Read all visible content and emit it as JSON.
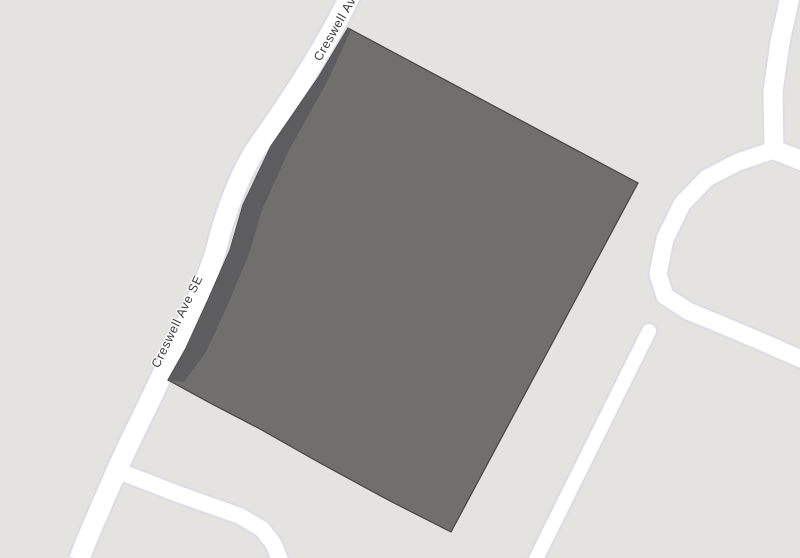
{
  "map": {
    "type": "street-map-view",
    "street_labels": [
      {
        "id": "creswell-label-top",
        "text": "Creswell Ave SE",
        "visible_portion": "Creswell A",
        "placement": "along road at top edge, clipped by viewport"
      },
      {
        "id": "creswell-label-mid",
        "text": "Creswell Ave SE",
        "visible_portion": "Creswell Ave SE",
        "placement": "along road at left-center"
      }
    ],
    "features": {
      "parcel": {
        "description": "large dark gray quadrilateral footprint with darker shaded band along its road-facing west edge and curved south-west edge"
      },
      "roads": [
        {
          "id": "creswell-ave-se",
          "name": "Creswell Ave SE",
          "path": "top edge to bottom-left corner, gently curving"
        },
        {
          "id": "southwest-branch",
          "name": "",
          "path": "branches from Creswell Ave toward bottom edge"
        },
        {
          "id": "northeast-vertical",
          "name": "",
          "path": "enters top-right corner, runs down to junction"
        },
        {
          "id": "northeast-east-spur",
          "name": "",
          "path": "junction to right edge"
        },
        {
          "id": "east-curving-road",
          "name": "",
          "path": "junction curving left then down-right to right edge"
        },
        {
          "id": "southeast-stub",
          "name": "",
          "path": "rounded dead-end running to bottom edge"
        }
      ]
    },
    "colors": {
      "background": "#e5e3df",
      "road_fill": "#ffffff",
      "road_casing": "#dbdce6",
      "parcel_fill": "#716f6e",
      "parcel_edge_strip": "#5d5c5e",
      "parcel_outline": "#454443",
      "label_text": "#3c3c3c",
      "label_halo": "#ffffff"
    }
  }
}
